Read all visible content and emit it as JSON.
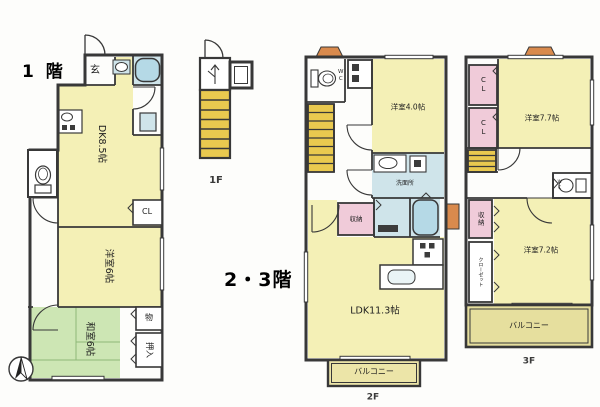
{
  "floor1": {
    "title": "1 階",
    "genkan": "玄",
    "dk": "DK8.5帖",
    "western": "洋室6帖",
    "japanese": "和室6帖",
    "storage": "物",
    "oshiire": "押入",
    "closet": "CL"
  },
  "stair_detail": {
    "label": "1F"
  },
  "upper": {
    "title": "2・3階"
  },
  "floor2": {
    "label": "2F",
    "wc": "WC",
    "western": "洋室4.0帖",
    "washroom": "洗面所",
    "storage": "収納",
    "ldk": "LDK11.3帖",
    "balcony": "バルコニー"
  },
  "floor3": {
    "label": "3F",
    "closet1": "CL",
    "closet2": "CL",
    "western_large": "洋室7.7帖",
    "wc": "WC",
    "storage": "収納",
    "closet_wardrobe": "クローゼット",
    "western_small": "洋室7.2帖",
    "balcony": "バルコニー"
  },
  "colors": {
    "room_yellow": "#f4f0b6",
    "tatami_green": "#cde6b4",
    "wet_blue": "#cfe4ea",
    "tub_blue": "#b5d9e6",
    "closet_pink": "#f0cbd9",
    "stair_yellow": "#e9c94f",
    "balcony_tan": "#ece5a8",
    "balcony_tan_dark": "#e6df9e",
    "accent_orange": "#d98a4d",
    "wall": "#383838"
  }
}
